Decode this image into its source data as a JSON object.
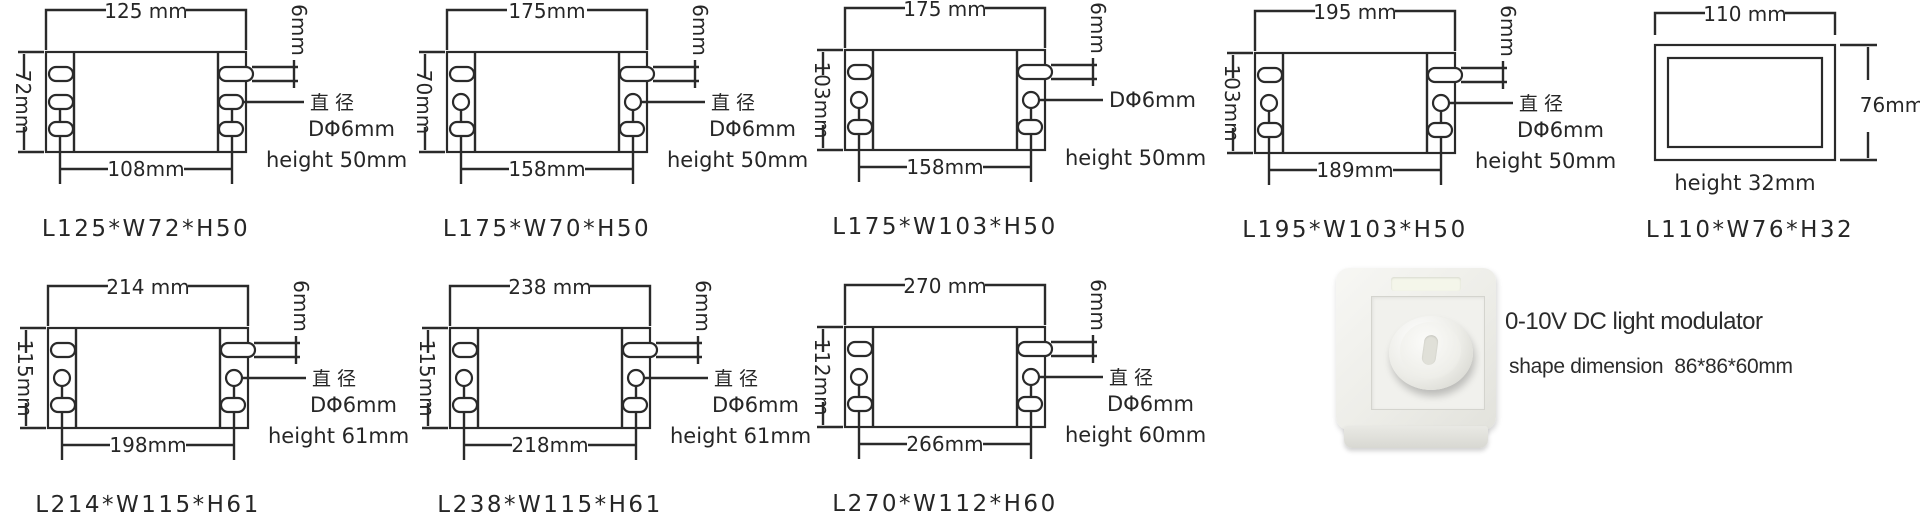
{
  "colors": {
    "line": "#2a2a2a",
    "background": "#ffffff",
    "plate": "#ededE8"
  },
  "diagrams": [
    {
      "top_width": "125 mm",
      "side_width": "72mm",
      "mount_span": "108mm",
      "slot_offset": "6mm",
      "diameter_note_line1": "直径",
      "diameter_note_line2": "DΦ6mm",
      "height_note": "height 50mm",
      "model": "L125*W72*H50"
    },
    {
      "top_width": "175mm",
      "side_width": "70mm",
      "mount_span": "158mm",
      "slot_offset": "6mm",
      "diameter_note_line1": "直径",
      "diameter_note_line2": "DΦ6mm",
      "height_note": "height 50mm",
      "model": "L175*W70*H50"
    },
    {
      "top_width": "175 mm",
      "side_width": "103mm",
      "mount_span": "158mm",
      "slot_offset": "6mm",
      "diameter_note_line1": "DΦ6mm",
      "diameter_note_line2": "",
      "height_note": "height 50mm",
      "model": "L175*W103*H50"
    },
    {
      "top_width": "195 mm",
      "side_width": "103mm",
      "mount_span": "189mm",
      "slot_offset": "6mm",
      "diameter_note_line1": "直径",
      "diameter_note_line2": "DΦ6mm",
      "height_note": "height 50mm",
      "model": "L195*W103*H50"
    },
    {
      "top_width": "214 mm",
      "side_width": "115mm",
      "mount_span": "198mm",
      "slot_offset": "6mm",
      "diameter_note_line1": "直径",
      "diameter_note_line2": "DΦ6mm",
      "height_note": "height 61mm",
      "model": "L214*W115*H61"
    },
    {
      "top_width": "238 mm",
      "side_width": "115mm",
      "mount_span": "218mm",
      "slot_offset": "6mm",
      "diameter_note_line1": "直径",
      "diameter_note_line2": "DΦ6mm",
      "height_note": "height 61mm",
      "model": "L238*W115*H61"
    },
    {
      "top_width": "270 mm",
      "side_width": "112mm",
      "mount_span": "266mm",
      "slot_offset": "6mm",
      "diameter_note_line1": "直径",
      "diameter_note_line2": "DΦ6mm",
      "height_note": "height 60mm",
      "model": "L270*W112*H60"
    }
  ],
  "plain_diagram": {
    "top_width": "110 mm",
    "side_width": "76mm",
    "height_note": "height 32mm",
    "model": "L110*W76*H32"
  },
  "product": {
    "title": "0-10V DC light modulator",
    "subtitle": "shape dimension  86*86*60mm"
  }
}
